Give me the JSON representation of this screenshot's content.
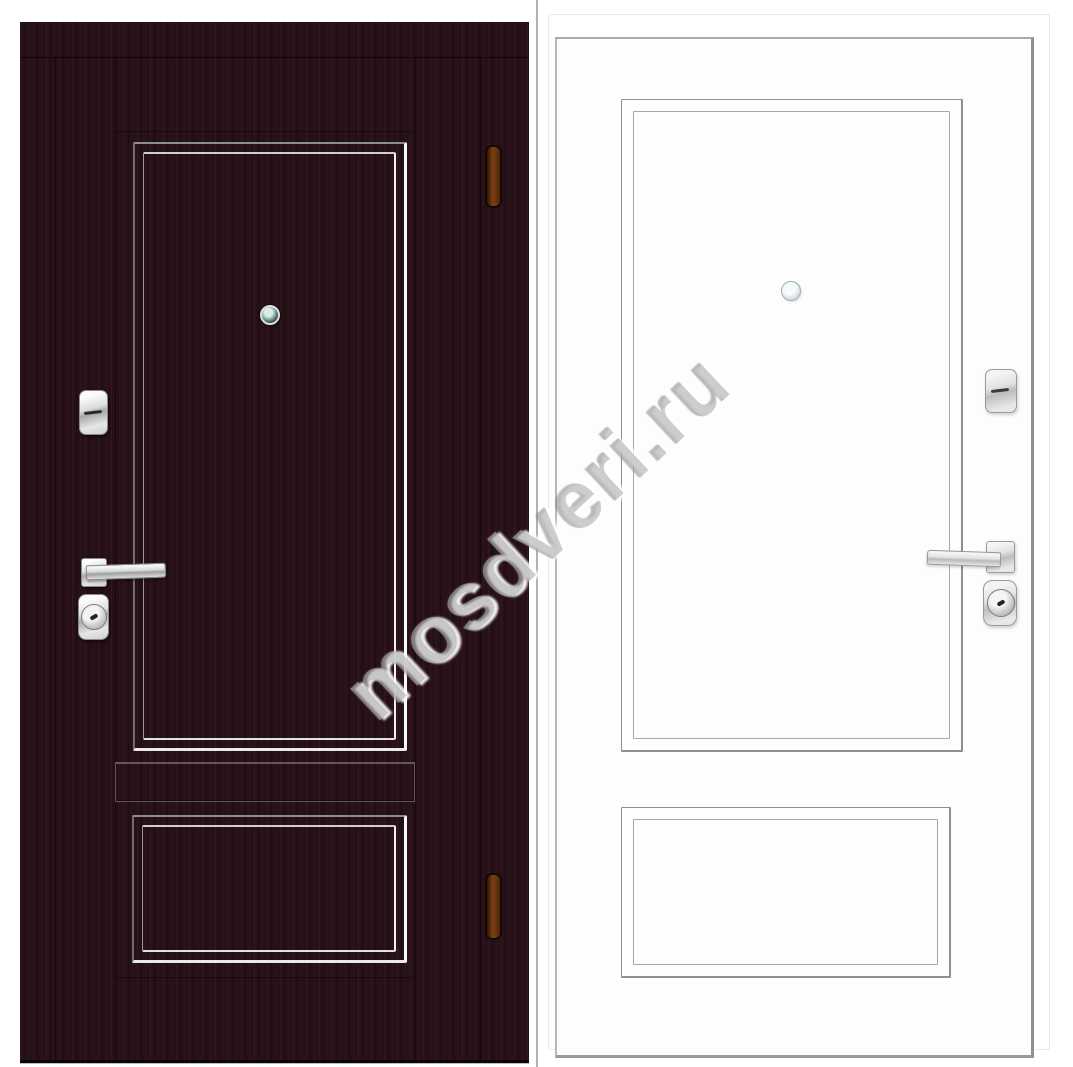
{
  "subject": "Steel entry door product photo: dark wenge front view (left) and white back view (right)",
  "watermark": {
    "text": "mosdveri.ru"
  },
  "front_view": {
    "finish": "dark wenge woodgrain",
    "hardware": [
      "peephole",
      "deadbolt-escutcheon",
      "lever-handle",
      "cylinder-escutcheon",
      "hinge-top",
      "hinge-bottom"
    ]
  },
  "back_view": {
    "finish": "white",
    "hardware": [
      "peephole",
      "deadbolt-escutcheon",
      "lever-handle",
      "cylinder-escutcheon"
    ]
  },
  "colors": {
    "background": "#ffffff",
    "dark_door_base": "#271118",
    "dark_door_grain": "#40202a",
    "molding_highlight": "#f8f8f8",
    "white_door_outline": "#9a9a9a",
    "chrome_hardware": "#d8d8d8",
    "hinge_bronze": "#6b3a12",
    "peephole_lens": "#8fb4ae",
    "watermark_gray": "#b0b0b0"
  }
}
